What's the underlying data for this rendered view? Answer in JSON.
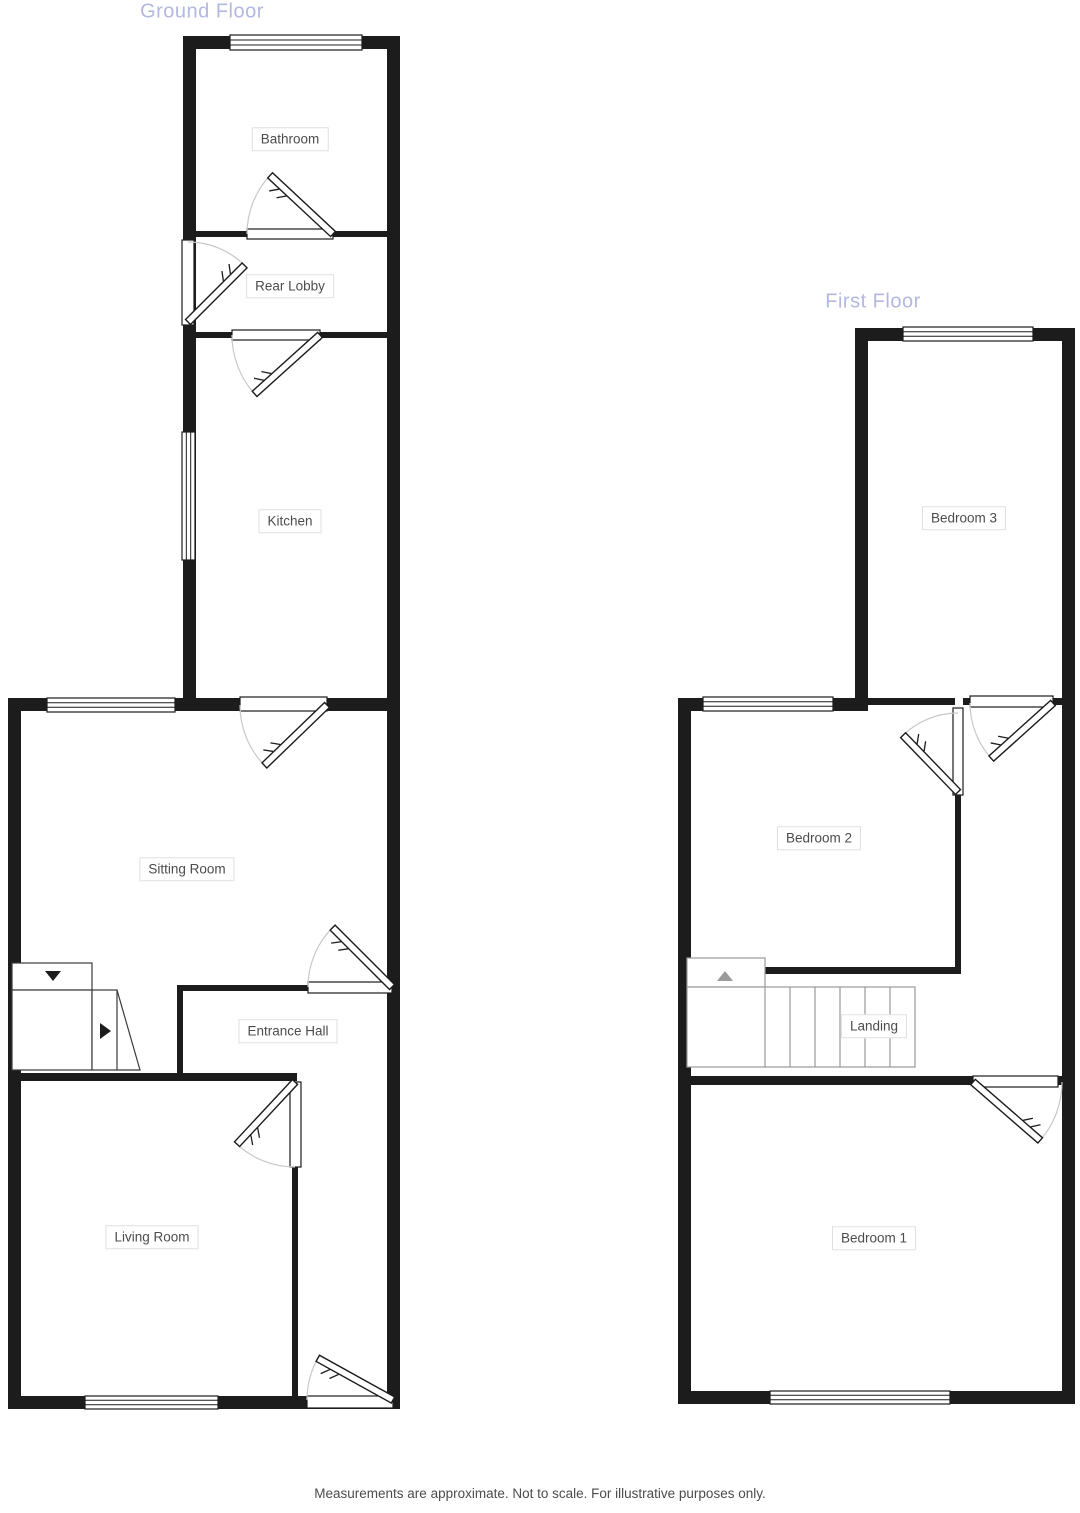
{
  "colors": {
    "wall": "#1c1c1c",
    "title": "#b3b8e0",
    "label_text": "#4c4c4c",
    "label_border": "#e0e0e0",
    "arc": "#c8c8c8",
    "stair": "#9a9a9a",
    "bg": "#ffffff"
  },
  "ground_floor": {
    "title": "Ground Floor",
    "rooms": [
      {
        "label": "Bathroom"
      },
      {
        "label": "Rear Lobby"
      },
      {
        "label": "Kitchen"
      },
      {
        "label": "Sitting Room"
      },
      {
        "label": "Entrance Hall"
      },
      {
        "label": "Living Room"
      }
    ],
    "stairs": {
      "down_arrow_icon": "triangle-down",
      "right_arrow_icon": "triangle-right"
    }
  },
  "first_floor": {
    "title": "First Floor",
    "rooms": [
      {
        "label": "Bedroom 3"
      },
      {
        "label": "Bedroom 2"
      },
      {
        "label": "Landing"
      },
      {
        "label": "Bedroom 1"
      }
    ],
    "stairs": {
      "up_arrow_icon": "triangle-up"
    }
  },
  "footer": {
    "disclaimer": "Measurements are approximate. Not to scale. For illustrative purposes only."
  }
}
